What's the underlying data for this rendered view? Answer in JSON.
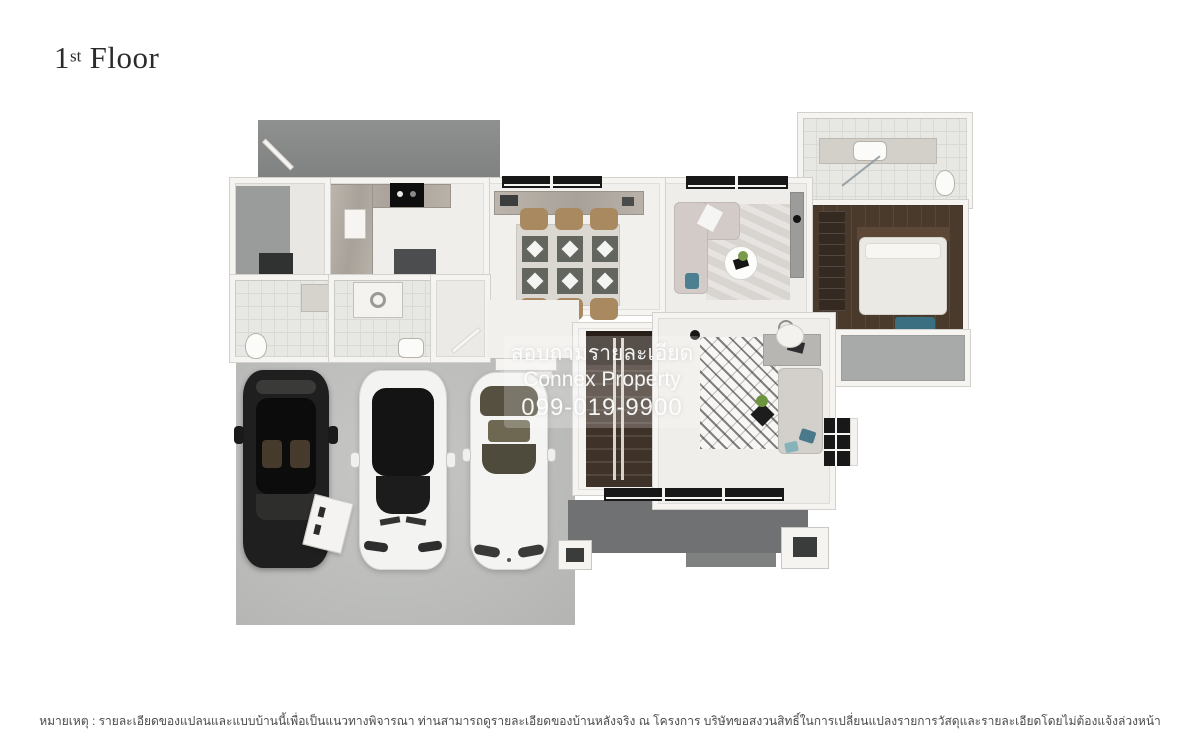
{
  "title": {
    "number": "1",
    "ordinal": "st",
    "word": " Floor"
  },
  "watermark": {
    "line1": "สอบถามรายละเอียด",
    "line2": "Connex Property",
    "line3": "099-019-9900"
  },
  "footer": {
    "note": "หมายเหตุ : รายละเอียดของแปลนและแบบบ้านนี้เพื่อเป็นแนวทางพิจารณา ท่านสามารถดูรายละเอียดของบ้านหลังจริง ณ โครงการ บริษัทขอสงวนสิทธิ์ในการเปลี่ยนแปลงรายการวัสดุและรายละเอียดโดยไม่ต้องแจ้งล่วงหน้า"
  },
  "colors": {
    "roof_gray": "#85878a",
    "deck_gray": "#6f7173",
    "concrete": "#bdbebc",
    "bedroom_wood": "#4a3a2c",
    "stair_wood": "#3f3229",
    "accent_blue": "#49798a",
    "chair_tan": "#a98a60",
    "wall_white": "#f5f4f1",
    "watermark_text": "#ffffff"
  }
}
